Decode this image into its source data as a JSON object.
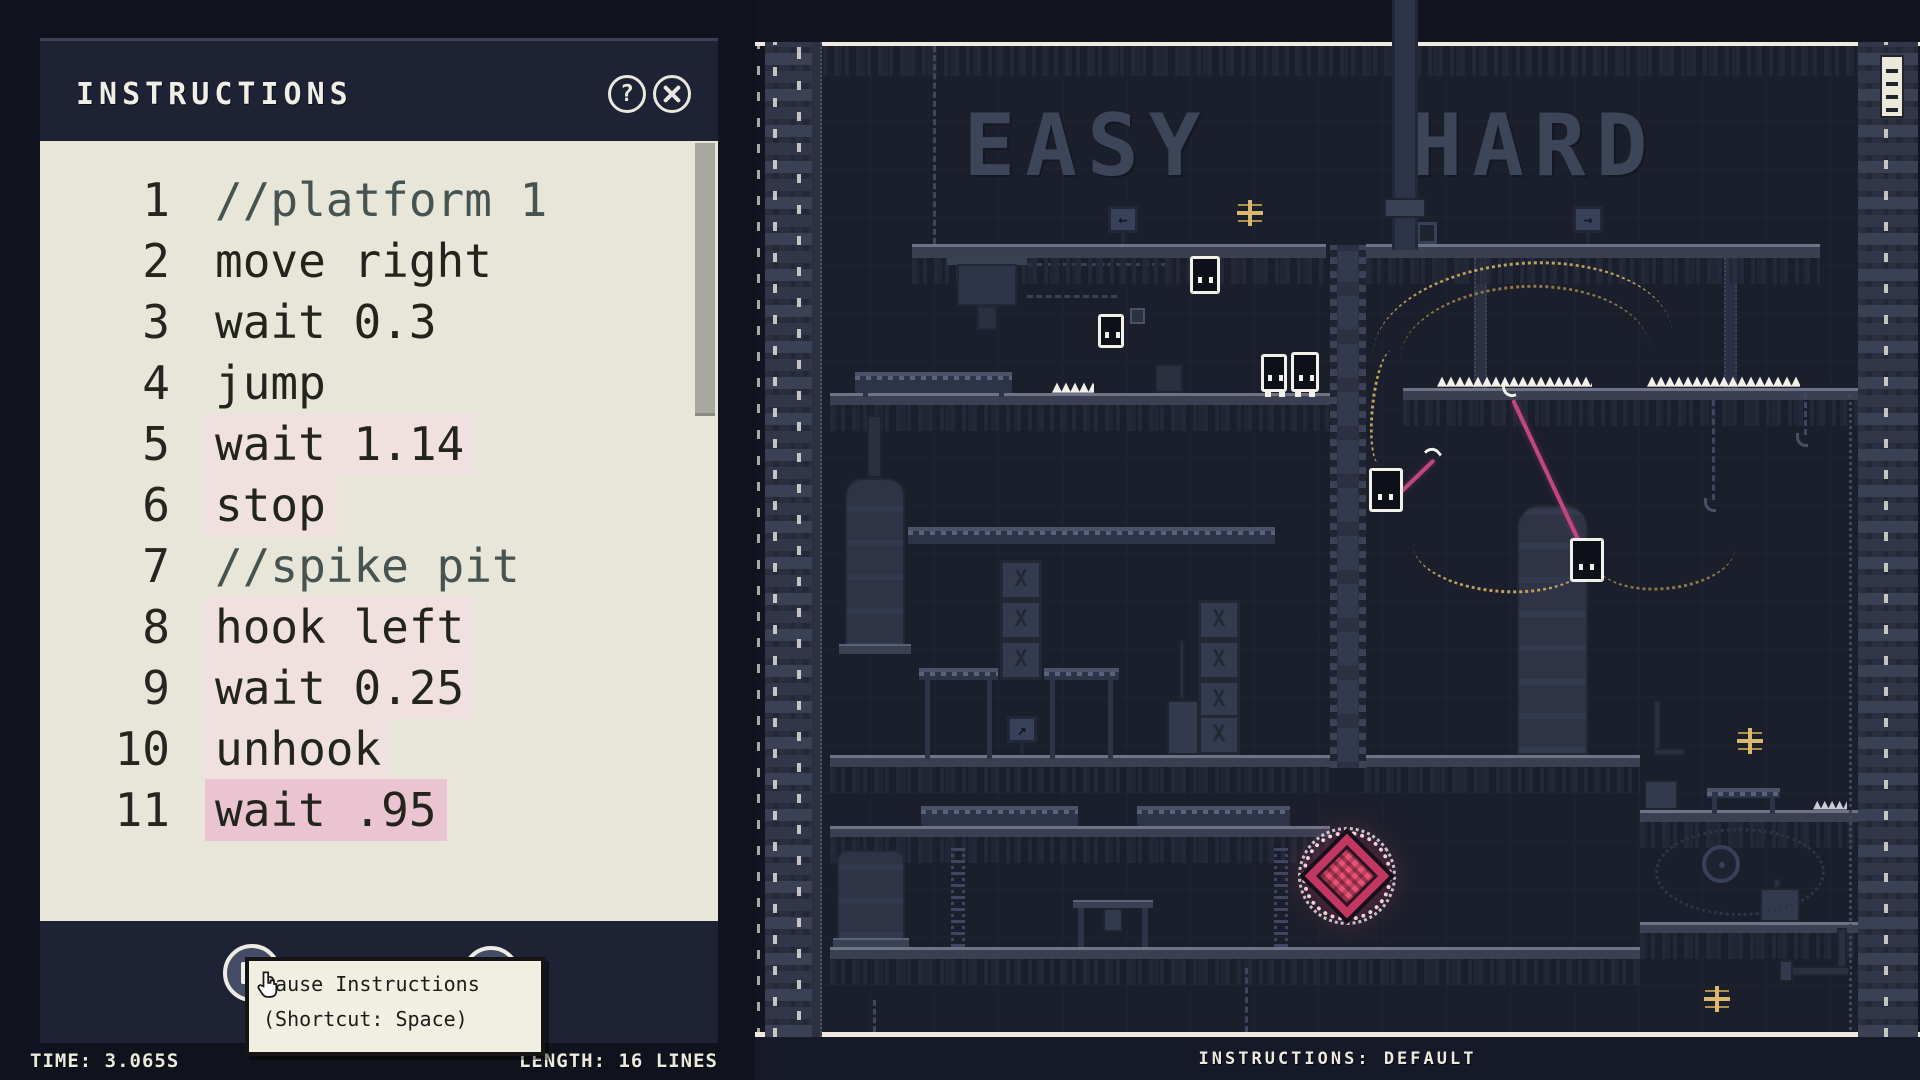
{
  "instructions_panel": {
    "title": "INSTRUCTIONS",
    "header_icons": {
      "help_label": "?"
    },
    "editor": {
      "lines": [
        {
          "num": "1",
          "text": "//platform 1",
          "kind": "comment",
          "hl": "none"
        },
        {
          "num": "2",
          "text": "move right",
          "kind": "code",
          "hl": "none"
        },
        {
          "num": "3",
          "text": "wait 0.3",
          "kind": "code",
          "hl": "none"
        },
        {
          "num": "4",
          "text": "jump",
          "kind": "code",
          "hl": "none"
        },
        {
          "num": "5",
          "text": "wait 1.14",
          "kind": "code",
          "hl": "light"
        },
        {
          "num": "6",
          "text": "stop",
          "kind": "code",
          "hl": "light"
        },
        {
          "num": "7",
          "text": "//spike pit",
          "kind": "comment",
          "hl": "none"
        },
        {
          "num": "8",
          "text": "hook left",
          "kind": "code",
          "hl": "light"
        },
        {
          "num": "9",
          "text": "wait 0.25",
          "kind": "code",
          "hl": "light"
        },
        {
          "num": "10",
          "text": "unhook",
          "kind": "code",
          "hl": "light"
        },
        {
          "num": "11",
          "text": "wait .95",
          "kind": "code",
          "hl": "strong"
        }
      ]
    },
    "tooltip": {
      "line1": "Pause Instructions",
      "line2": "(Shortcut: Space)"
    },
    "status": {
      "time": "TIME: 3.065S",
      "length": "LENGTH: 16 LINES"
    }
  },
  "game": {
    "wall_labels": {
      "easy": "EASY",
      "hard": "HARD"
    },
    "status_label": "INSTRUCTIONS: DEFAULT",
    "colors": {
      "rope_pink": "#c2477e",
      "gem_pink": "#e8436f",
      "particle_gold": "#bfa05e",
      "frame_cream": "#efeadb",
      "highlight_light": "#f0e1e0",
      "highlight_strong": "#eac4d0"
    }
  }
}
